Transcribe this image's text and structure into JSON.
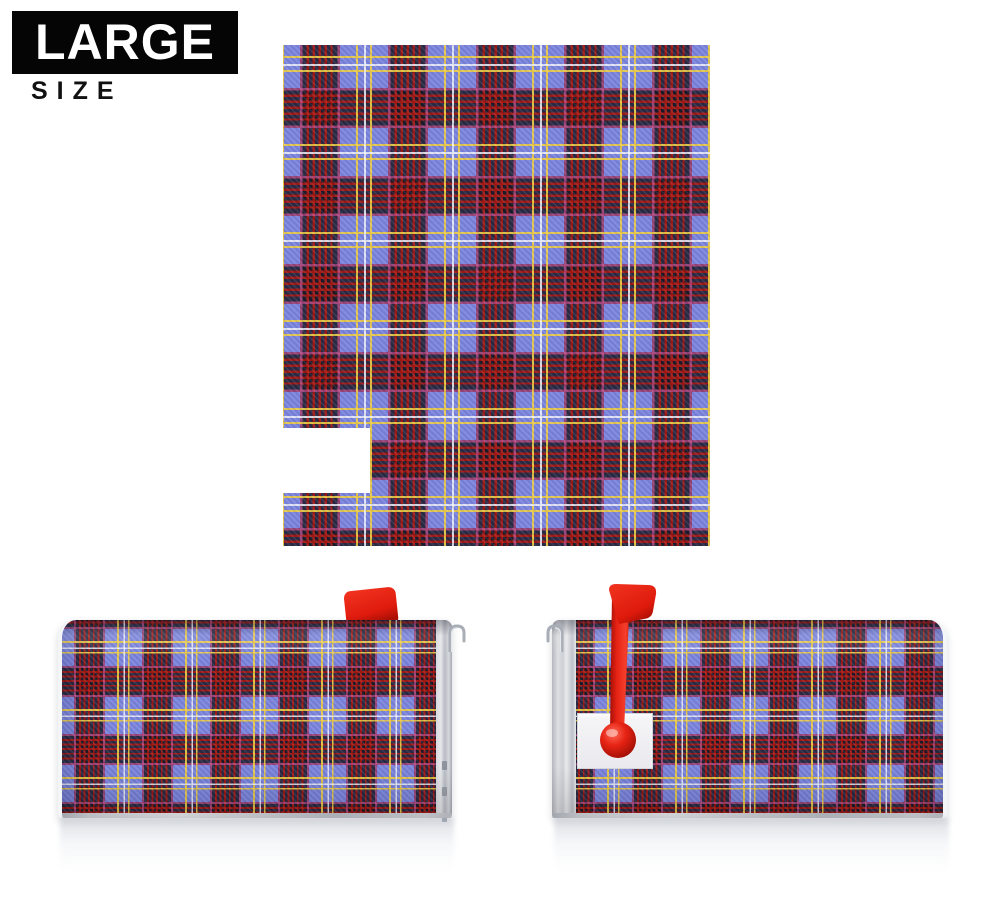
{
  "badge": {
    "title": "LARGE",
    "subtitle": "SIZE"
  },
  "colors": {
    "page_bg": "#ffffff",
    "badge_bg": "#050505",
    "badge_text": "#ffffff",
    "badge_subtitle_text": "#111111",
    "tartan_blue": "#7b84dc",
    "tartan_dark": "#221f2b",
    "tartan_red": "#ac1812",
    "tartan_pink": "#c65091",
    "tartan_yellow": "#eecd44",
    "tartan_white": "#f0f2fa",
    "flag_red": "#e82517",
    "mailbox_metal": "#e7e9ee"
  }
}
